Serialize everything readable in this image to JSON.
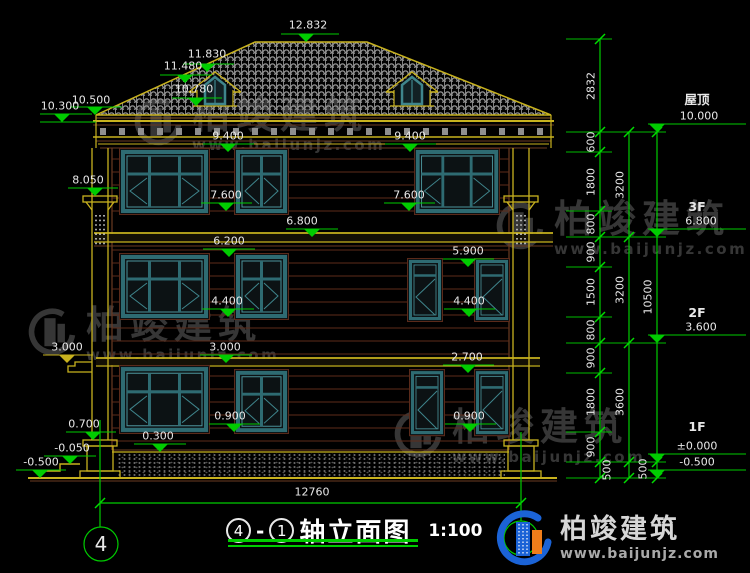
{
  "drawing": {
    "title_text": "轴立面图",
    "axis_left": "4",
    "axis_right": "1",
    "title_separator": "-",
    "scale": "1:100",
    "overall_width": "12760"
  },
  "levels_right": [
    {
      "label": "屋顶",
      "value": "10.000"
    },
    {
      "label": "3F",
      "value": "6.800"
    },
    {
      "label": "2F",
      "value": "3.600"
    },
    {
      "label": "1F",
      "value": "±0.000"
    },
    {
      "label": "",
      "value": "-0.500"
    }
  ],
  "facade_elevations": [
    "12.832",
    "11.830",
    "11.480",
    "10.780",
    "10.500",
    "10.300",
    "9.400",
    "9.400",
    "8.050",
    "7.600",
    "7.600",
    "6.800",
    "6.200",
    "5.900",
    "4.400",
    "4.400",
    "3.000",
    "3.000",
    "2.700",
    "0.900",
    "0.900",
    "0.700",
    "0.300",
    "-0.050",
    "-0.500"
  ],
  "dims_inner": [
    "2832",
    "600",
    "1800",
    "800",
    "900",
    "1500",
    "800",
    "900",
    "1800",
    "900",
    "500"
  ],
  "dims_middle": [
    "3200",
    "3200",
    "3600",
    "500"
  ],
  "dims_outer": [
    "10500"
  ],
  "watermark": {
    "brand": "柏竣建筑",
    "site": "www.baijunjz.com"
  },
  "logo": {
    "brand": "柏竣建筑",
    "site": "www.baijunjz.com"
  }
}
